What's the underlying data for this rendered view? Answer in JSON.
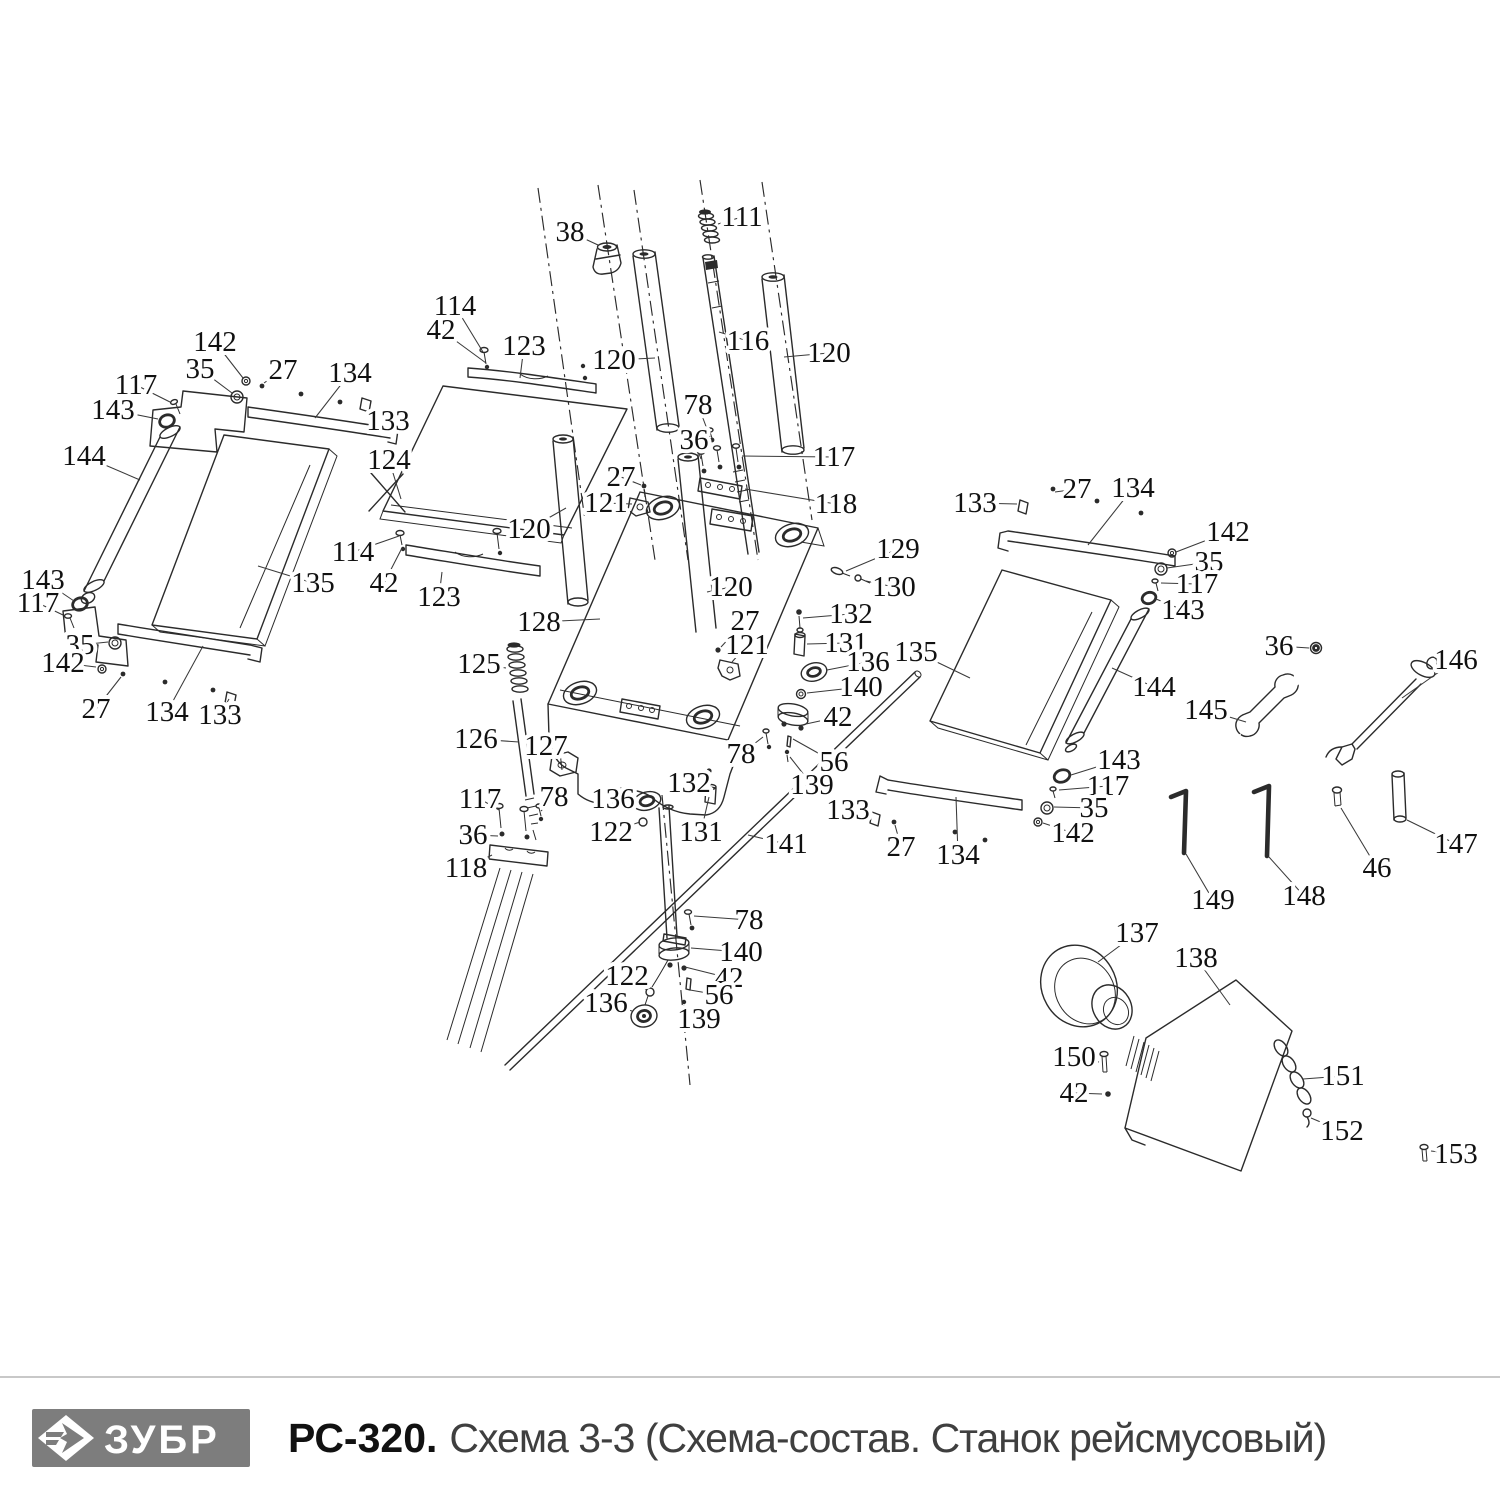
{
  "footer": {
    "brand": "ЗУБР",
    "model": "РС-320.",
    "subtitle": "Схема 3-3 (Схема-состав. Станок рейсмусовый)"
  },
  "colors": {
    "drawing_line": "#2b2b2b",
    "callout_text": "#111111",
    "logo_bg": "#7d7d7d",
    "logo_text": "#ffffff",
    "separator": "#c8c8c8",
    "subtitle_text": "#3f3f3f"
  },
  "diagram": {
    "type": "exploded-parts-diagram",
    "callouts": [
      {
        "n": "38",
        "x": 570,
        "y": 232,
        "tx": 598,
        "ty": 245
      },
      {
        "n": "111",
        "x": 742,
        "y": 217,
        "tx": 718,
        "ty": 224
      },
      {
        "n": "114",
        "x": 455,
        "y": 306,
        "tx": 483,
        "ty": 352
      },
      {
        "n": "42",
        "x": 441,
        "y": 330,
        "tx": 486,
        "ty": 363
      },
      {
        "n": "123",
        "x": 524,
        "y": 346,
        "tx": 520,
        "ty": 378
      },
      {
        "n": "120",
        "x": 614,
        "y": 360,
        "tx": 655,
        "ty": 358
      },
      {
        "n": "116",
        "x": 748,
        "y": 341,
        "tx": 719,
        "ty": 332
      },
      {
        "n": "120",
        "x": 829,
        "y": 353,
        "tx": 784,
        "ty": 357
      },
      {
        "n": "142",
        "x": 215,
        "y": 342,
        "tx": 243,
        "ty": 378
      },
      {
        "n": "35",
        "x": 200,
        "y": 369,
        "tx": 232,
        "ty": 393
      },
      {
        "n": "117",
        "x": 136,
        "y": 385,
        "tx": 170,
        "ty": 402
      },
      {
        "n": "143",
        "x": 113,
        "y": 410,
        "tx": 158,
        "ty": 419
      },
      {
        "n": "27",
        "x": 283,
        "y": 370,
        "tx": 264,
        "ty": 383
      },
      {
        "n": "134",
        "x": 350,
        "y": 373,
        "tx": 315,
        "ty": 418
      },
      {
        "n": "133",
        "x": 388,
        "y": 421,
        "tx": 371,
        "ty": 409
      },
      {
        "n": "144",
        "x": 84,
        "y": 456,
        "tx": 140,
        "ty": 480
      },
      {
        "n": "124",
        "x": 389,
        "y": 460,
        "tx": 401,
        "ty": 499
      },
      {
        "n": "135",
        "x": 313,
        "y": 583,
        "tx": 258,
        "ty": 566
      },
      {
        "n": "143",
        "x": 43,
        "y": 580,
        "tx": 74,
        "ty": 601
      },
      {
        "n": "117",
        "x": 38,
        "y": 603,
        "tx": 63,
        "ty": 615
      },
      {
        "n": "35",
        "x": 80,
        "y": 645,
        "tx": 108,
        "ty": 642
      },
      {
        "n": "142",
        "x": 63,
        "y": 663,
        "tx": 96,
        "ty": 667
      },
      {
        "n": "27",
        "x": 96,
        "y": 709,
        "tx": 121,
        "ty": 677
      },
      {
        "n": "134",
        "x": 167,
        "y": 712,
        "tx": 203,
        "ty": 646
      },
      {
        "n": "133",
        "x": 220,
        "y": 715,
        "tx": 229,
        "ty": 699
      },
      {
        "n": "114",
        "x": 353,
        "y": 552,
        "tx": 399,
        "ty": 536
      },
      {
        "n": "42",
        "x": 384,
        "y": 583,
        "tx": 402,
        "ty": 548
      },
      {
        "n": "123",
        "x": 439,
        "y": 597,
        "tx": 442,
        "ty": 572
      },
      {
        "n": "120",
        "x": 529,
        "y": 529,
        "tx": 566,
        "ty": 508
      },
      {
        "n": "27",
        "x": 621,
        "y": 477,
        "tx": 641,
        "ty": 485
      },
      {
        "n": "121",
        "x": 606,
        "y": 503,
        "tx": 632,
        "ty": 504
      },
      {
        "n": "128",
        "x": 539,
        "y": 622,
        "tx": 600,
        "ty": 619
      },
      {
        "n": "125",
        "x": 479,
        "y": 664,
        "tx": 506,
        "ty": 668
      },
      {
        "n": "126",
        "x": 476,
        "y": 739,
        "tx": 519,
        "ty": 742
      },
      {
        "n": "127",
        "x": 546,
        "y": 746,
        "tx": 559,
        "ty": 758
      },
      {
        "n": "117",
        "x": 480,
        "y": 799,
        "tx": 499,
        "ty": 810
      },
      {
        "n": "78",
        "x": 554,
        "y": 797,
        "tx": 541,
        "ty": 811
      },
      {
        "n": "36",
        "x": 473,
        "y": 835,
        "tx": 498,
        "ty": 836
      },
      {
        "n": "118",
        "x": 466,
        "y": 868,
        "tx": 492,
        "ty": 855
      },
      {
        "n": "136",
        "x": 613,
        "y": 799,
        "tx": 636,
        "ty": 801
      },
      {
        "n": "122",
        "x": 611,
        "y": 832,
        "tx": 640,
        "ty": 822
      },
      {
        "n": "132",
        "x": 689,
        "y": 783,
        "tx": 706,
        "ty": 774
      },
      {
        "n": "131",
        "x": 701,
        "y": 832,
        "tx": 709,
        "ty": 797
      },
      {
        "n": "141",
        "x": 786,
        "y": 844,
        "tx": 748,
        "ty": 835
      },
      {
        "n": "78",
        "x": 698,
        "y": 405,
        "tx": 710,
        "ty": 437
      },
      {
        "n": "36",
        "x": 694,
        "y": 440,
        "tx": 701,
        "ty": 459
      },
      {
        "n": "117",
        "x": 834,
        "y": 457,
        "tx": 742,
        "ty": 456
      },
      {
        "n": "118",
        "x": 836,
        "y": 504,
        "tx": 745,
        "ty": 489
      },
      {
        "n": "129",
        "x": 898,
        "y": 549,
        "tx": 846,
        "ty": 571
      },
      {
        "n": "130",
        "x": 894,
        "y": 587,
        "tx": 866,
        "ty": 581
      },
      {
        "n": "120",
        "x": 731,
        "y": 587,
        "tx": 707,
        "ty": 592
      },
      {
        "n": "132",
        "x": 851,
        "y": 614,
        "tx": 803,
        "ty": 618
      },
      {
        "n": "27",
        "x": 745,
        "y": 621,
        "tx": 721,
        "ty": 647
      },
      {
        "n": "121",
        "x": 747,
        "y": 645,
        "tx": 732,
        "ty": 662
      },
      {
        "n": "131",
        "x": 846,
        "y": 643,
        "tx": 807,
        "ty": 644
      },
      {
        "n": "136",
        "x": 868,
        "y": 662,
        "tx": 827,
        "ty": 670
      },
      {
        "n": "140",
        "x": 861,
        "y": 687,
        "tx": 807,
        "ty": 693
      },
      {
        "n": "42",
        "x": 838,
        "y": 717,
        "tx": 806,
        "ty": 724
      },
      {
        "n": "135",
        "x": 916,
        "y": 652,
        "tx": 970,
        "ty": 678
      },
      {
        "n": "78",
        "x": 741,
        "y": 754,
        "tx": 763,
        "ty": 737
      },
      {
        "n": "56",
        "x": 834,
        "y": 762,
        "tx": 793,
        "ty": 739
      },
      {
        "n": "139",
        "x": 812,
        "y": 785,
        "tx": 790,
        "ty": 757
      },
      {
        "n": "133",
        "x": 848,
        "y": 810,
        "tx": 871,
        "ty": 813
      },
      {
        "n": "27",
        "x": 901,
        "y": 847,
        "tx": 895,
        "ty": 825
      },
      {
        "n": "134",
        "x": 958,
        "y": 855,
        "tx": 956,
        "ty": 797
      },
      {
        "n": "78",
        "x": 749,
        "y": 920,
        "tx": 694,
        "ty": 916
      },
      {
        "n": "140",
        "x": 741,
        "y": 952,
        "tx": 691,
        "ty": 948
      },
      {
        "n": "42",
        "x": 729,
        "y": 978,
        "tx": 685,
        "ty": 967
      },
      {
        "n": "56",
        "x": 719,
        "y": 995,
        "tx": 690,
        "ty": 990
      },
      {
        "n": "139",
        "x": 699,
        "y": 1019,
        "tx": 686,
        "ty": 1008
      },
      {
        "n": "122",
        "x": 627,
        "y": 976,
        "tx": 647,
        "ty": 990
      },
      {
        "n": "136",
        "x": 606,
        "y": 1003,
        "tx": 632,
        "ty": 1011
      },
      {
        "n": "133",
        "x": 975,
        "y": 503,
        "tx": 1017,
        "ty": 504
      },
      {
        "n": "27",
        "x": 1077,
        "y": 489,
        "tx": 1055,
        "ty": 492
      },
      {
        "n": "134",
        "x": 1133,
        "y": 488,
        "tx": 1088,
        "ty": 545
      },
      {
        "n": "142",
        "x": 1228,
        "y": 532,
        "tx": 1176,
        "ty": 552
      },
      {
        "n": "35",
        "x": 1209,
        "y": 562,
        "tx": 1167,
        "ty": 568
      },
      {
        "n": "117",
        "x": 1197,
        "y": 584,
        "tx": 1161,
        "ty": 583
      },
      {
        "n": "143",
        "x": 1183,
        "y": 610,
        "tx": 1156,
        "ty": 599
      },
      {
        "n": "144",
        "x": 1154,
        "y": 687,
        "tx": 1112,
        "ty": 668
      },
      {
        "n": "36",
        "x": 1279,
        "y": 646,
        "tx": 1309,
        "ty": 648
      },
      {
        "n": "146",
        "x": 1456,
        "y": 660,
        "tx": 1402,
        "ty": 698
      },
      {
        "n": "145",
        "x": 1206,
        "y": 710,
        "tx": 1246,
        "ty": 722
      },
      {
        "n": "143",
        "x": 1119,
        "y": 760,
        "tx": 1071,
        "ty": 775
      },
      {
        "n": "117",
        "x": 1108,
        "y": 786,
        "tx": 1059,
        "ty": 790
      },
      {
        "n": "35",
        "x": 1094,
        "y": 808,
        "tx": 1054,
        "ty": 807
      },
      {
        "n": "142",
        "x": 1073,
        "y": 833,
        "tx": 1043,
        "ty": 823
      },
      {
        "n": "147",
        "x": 1456,
        "y": 844,
        "tx": 1407,
        "ty": 820
      },
      {
        "n": "46",
        "x": 1377,
        "y": 868,
        "tx": 1341,
        "ty": 808
      },
      {
        "n": "148",
        "x": 1304,
        "y": 896,
        "tx": 1269,
        "ty": 857
      },
      {
        "n": "149",
        "x": 1213,
        "y": 900,
        "tx": 1186,
        "ty": 854
      },
      {
        "n": "137",
        "x": 1137,
        "y": 933,
        "tx": 1098,
        "ty": 962
      },
      {
        "n": "138",
        "x": 1196,
        "y": 958,
        "tx": 1230,
        "ty": 1005
      },
      {
        "n": "150",
        "x": 1074,
        "y": 1057,
        "tx": 1099,
        "ty": 1062
      },
      {
        "n": "42",
        "x": 1074,
        "y": 1093,
        "tx": 1102,
        "ty": 1094
      },
      {
        "n": "151",
        "x": 1343,
        "y": 1076,
        "tx": 1303,
        "ty": 1079
      },
      {
        "n": "152",
        "x": 1342,
        "y": 1131,
        "tx": 1311,
        "ty": 1118
      },
      {
        "n": "153",
        "x": 1456,
        "y": 1154,
        "tx": 1431,
        "ty": 1151
      }
    ]
  }
}
